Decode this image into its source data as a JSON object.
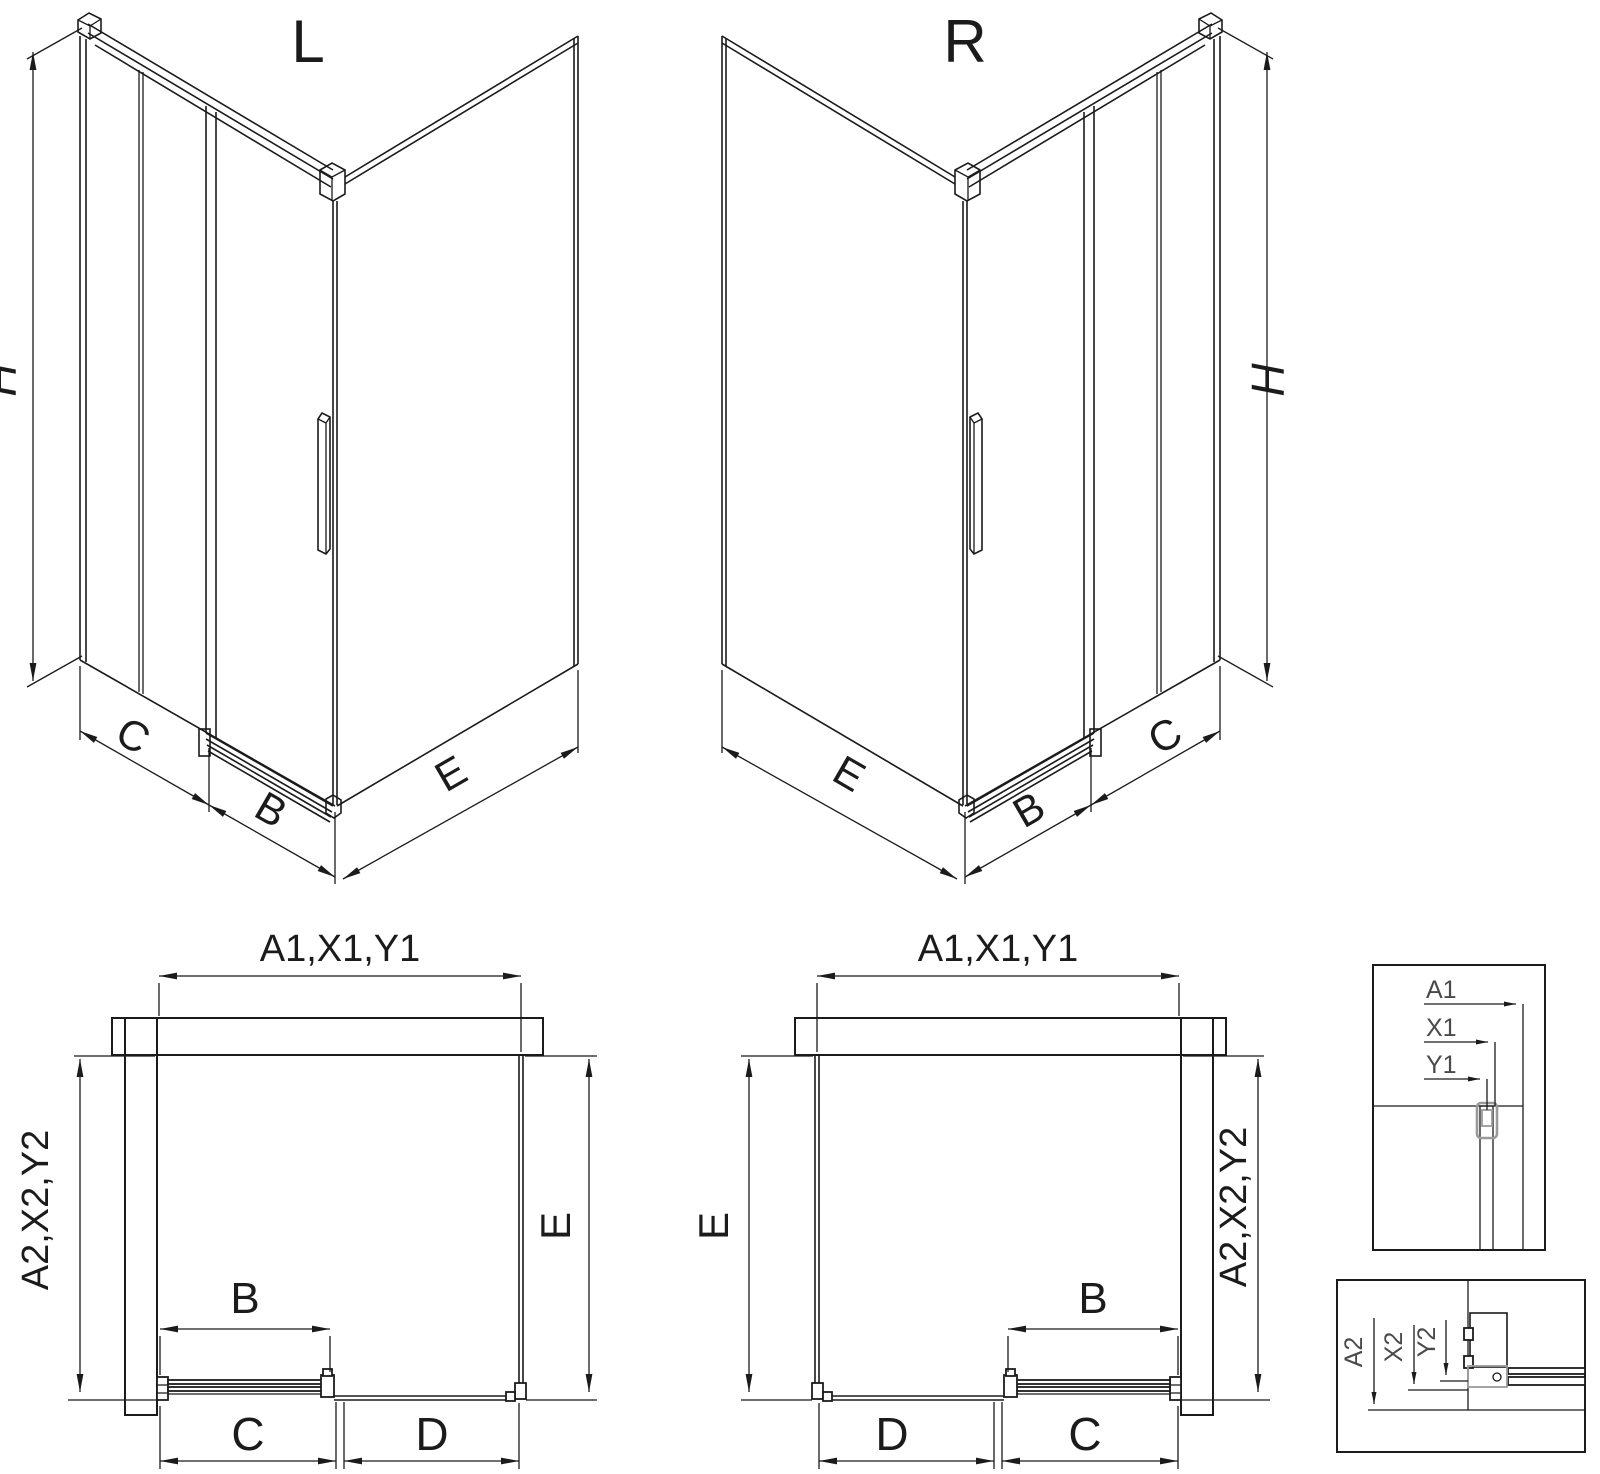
{
  "drawing": {
    "type": "shower-enclosure-technical-diagram",
    "colors": {
      "line": "#1b1b1b",
      "hardware_gray": "#9a9a9a",
      "detail_label": "#4a4a4a",
      "background": "#ffffff"
    }
  },
  "views": {
    "iso_left": {
      "title": "L",
      "height_label": "H",
      "bottom_labels": [
        "C",
        "B",
        "E"
      ]
    },
    "iso_right": {
      "title": "R",
      "height_label": "H",
      "bottom_labels": [
        "E",
        "B",
        "C"
      ]
    },
    "plan_left": {
      "top_dim": "A1,X1,Y1",
      "left_dim": "A2,X2,Y2",
      "right_dim": "E",
      "door_dim": "B",
      "bottom_dims": [
        "C",
        "D"
      ]
    },
    "plan_right": {
      "top_dim": "A1,X1,Y1",
      "left_dim": "E",
      "right_dim": "A2,X2,Y2",
      "door_dim": "B",
      "bottom_dims": [
        "D",
        "C"
      ]
    },
    "detail_top": {
      "labels": [
        "A1",
        "X1",
        "Y1"
      ]
    },
    "detail_bottom": {
      "labels": [
        "A2",
        "X2",
        "Y2"
      ]
    }
  }
}
